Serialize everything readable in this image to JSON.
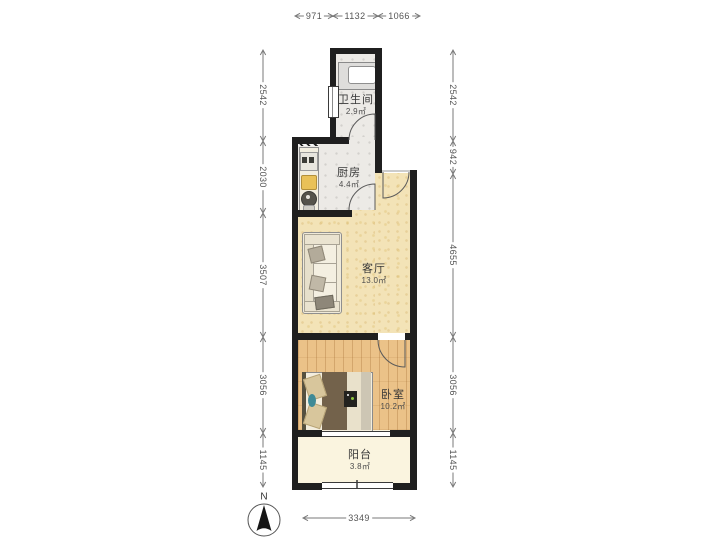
{
  "rooms": [
    {
      "name": "卫生间",
      "area": "2.9㎡"
    },
    {
      "name": "厨房",
      "area": "4.4㎡"
    },
    {
      "name": "客厅",
      "area": "13.0㎡"
    },
    {
      "name": "卧室",
      "area": "10.2㎡"
    },
    {
      "name": "阳台",
      "area": "3.8㎡"
    }
  ],
  "dims": {
    "top": [
      "971",
      "1132",
      "1066"
    ],
    "left": [
      "2542",
      "2030",
      "3507",
      "3056",
      "1145"
    ],
    "right": [
      "2542",
      "942",
      "4655",
      "3056",
      "1145"
    ],
    "bottom": [
      "3349"
    ]
  },
  "compass": {
    "label": "N"
  },
  "colors": {
    "wall": "#1f1f1f",
    "tile_floor": "#eceae6",
    "living_floor": "#f3e3b7",
    "bedroom_floor": "#ebc288",
    "balcony_floor": "#faf4df",
    "dimension": "#777777",
    "duvet": "#73624b",
    "cutting_board": "#e9c158"
  }
}
